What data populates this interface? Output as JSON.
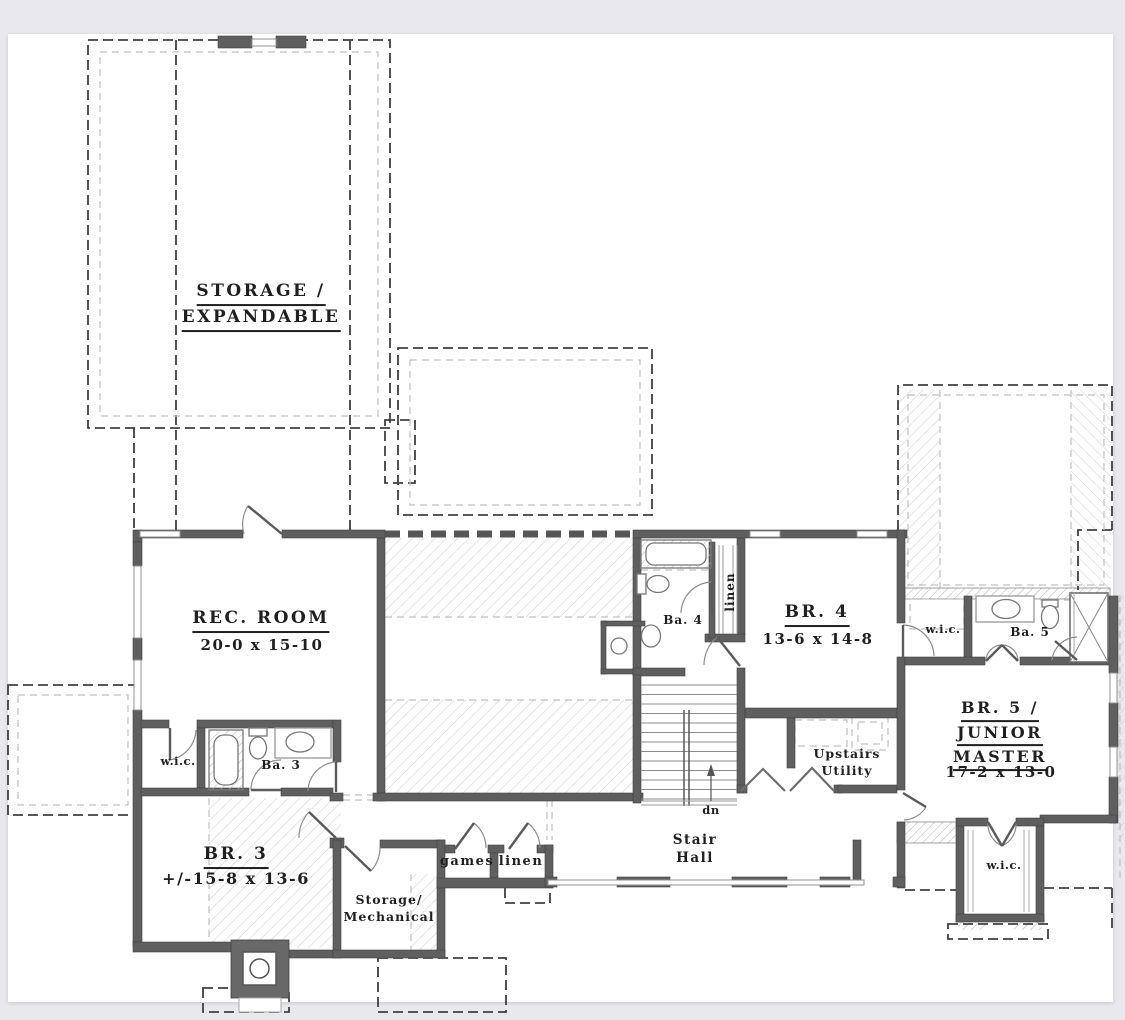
{
  "colors": {
    "background": "#e9e9ed",
    "paper": "#ffffff",
    "wall": "#5f5f5f",
    "text": "#1f1f1f"
  },
  "rooms": {
    "storage_expandable": {
      "line1": "STORAGE /",
      "line2": "EXPANDABLE"
    },
    "rec_room": {
      "name": "REC. ROOM",
      "dims": "20-0 x 15-10"
    },
    "bath_4": {
      "name": "Ba. 4"
    },
    "linen_upper": {
      "name": "linen"
    },
    "bedroom_4": {
      "name": "BR. 4",
      "dims": "13-6 x 14-8"
    },
    "wic_master": {
      "name": "w.i.c."
    },
    "bath_5": {
      "name": "Ba. 5"
    },
    "bedroom_5": {
      "line1": "BR. 5 /",
      "line2": "JUNIOR",
      "line3": "MASTER",
      "dims": "17-2 x 13-0"
    },
    "wic_3": {
      "name": "w.i.c."
    },
    "bath_3": {
      "name": "Ba. 3"
    },
    "bedroom_3": {
      "name": "BR. 3",
      "dims": "+/-15-8 x 13-6"
    },
    "storage_mechanical": {
      "line1": "Storage/",
      "line2": "Mechanical"
    },
    "games_closet": {
      "name": "games"
    },
    "linen_lower": {
      "name": "linen"
    },
    "stair_hall": {
      "line1": "Stair",
      "line2": "Hall"
    },
    "stair_note": {
      "label": "dn"
    },
    "upstairs_utility": {
      "line1": "Upstairs",
      "line2": "Utility"
    },
    "wic_bedroom5": {
      "name": "w.i.c."
    }
  }
}
